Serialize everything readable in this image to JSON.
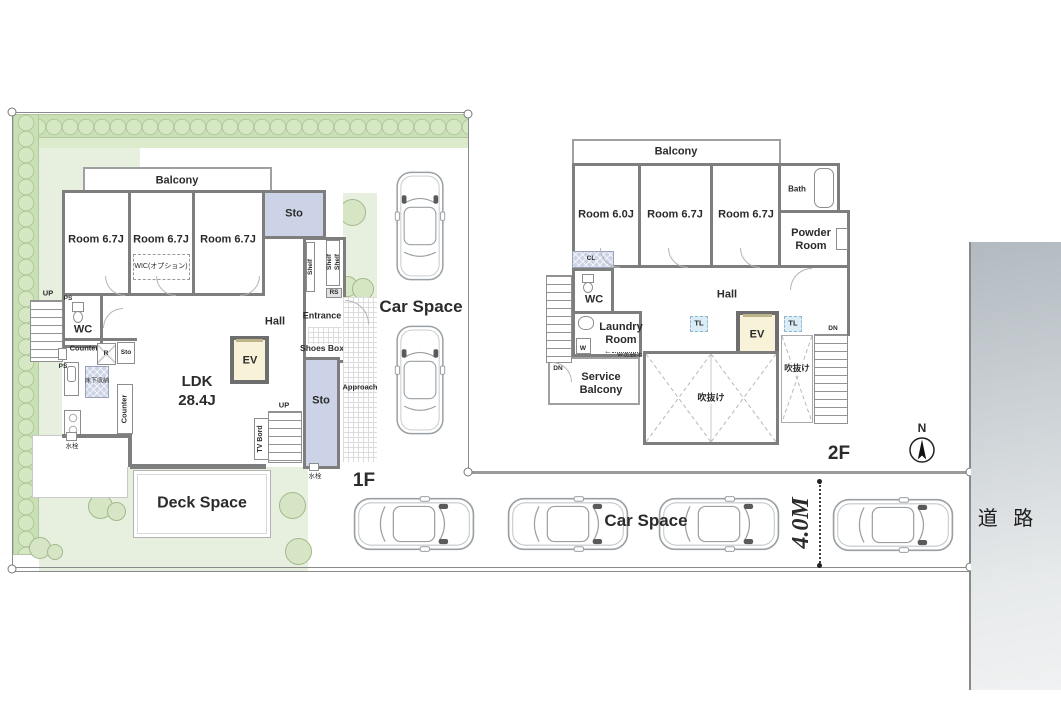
{
  "floor1": {
    "floor_label": "1F",
    "balcony_label": "Balcony",
    "rooms": [
      "Room 6.7J",
      "Room 6.7J",
      "Room 6.7J"
    ],
    "wic_label": "WIC(オプション)",
    "sto_label": "Sto",
    "shelf_label": "Shelf",
    "rs_label": "RS",
    "entrance_label": "Entrance",
    "shoes_box_label": "Shoes Box",
    "hall_label": "Hall",
    "wc_label": "WC",
    "up_label": "UP",
    "ps_label": "PS",
    "counter_label": "Counter",
    "fridge_label": "R",
    "underfloor_label": "床下収納",
    "ldk_label": "LDK",
    "ldk_size": "28.4J",
    "ev_label": "EV",
    "tv_board_label": "TV Bord",
    "approach_label": "Approach",
    "awning_label": "電動オーニング",
    "deck_label": "Deck Space",
    "faucet_label": "水栓",
    "car_space_label": "Car Space"
  },
  "floor2": {
    "floor_label": "2F",
    "balcony_label": "Balcony",
    "rooms": [
      "Room 6.0J",
      "Room 6.7J",
      "Room 6.7J"
    ],
    "bath_label": "Bath",
    "powder_label": "Powder Room",
    "cl_label": "CL",
    "ps_label": "PS",
    "wc_label": "WC",
    "hall_label": "Hall",
    "laundry_label": "Laundry Room",
    "washer_label": "W",
    "drying_label": "室内物干し",
    "service_balcony_label": "Service Balcony",
    "tl_label": "TL",
    "ev_label": "EV",
    "dn_label": "DN",
    "void_label": "吹抜け"
  },
  "site": {
    "car_space_label": "Car Space",
    "road_label": "道 路",
    "road_width_label": "4.0M",
    "north_label": "N"
  },
  "icons": {
    "up_arrow": "↑",
    "left_arrow": "←"
  },
  "colors": {
    "wall": "#7e7e7e",
    "storage_fill": "#ccd3e6",
    "ev_fill": "#f8f3d8",
    "tl_fill": "#daecf6",
    "garden": "#e7f0de",
    "hedge": "#cfe3ba",
    "road_top": "#b2bac0",
    "road_bottom": "#f0f1f2"
  }
}
